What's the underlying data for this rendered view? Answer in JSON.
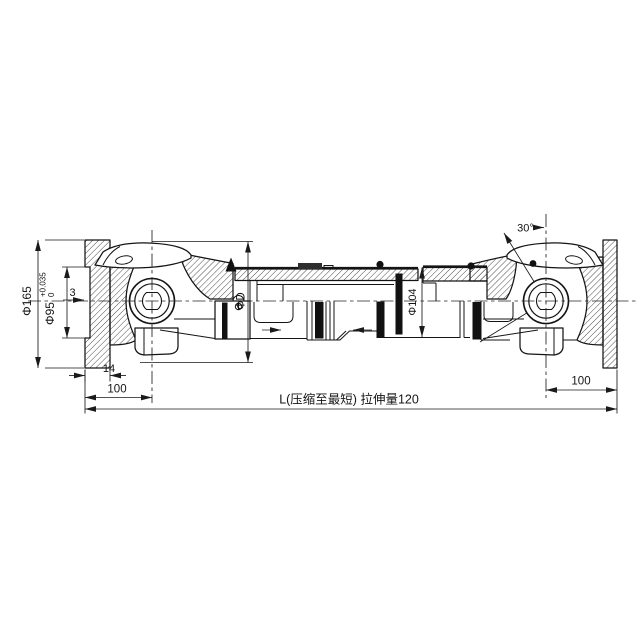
{
  "dimensions": {
    "flange_od": "Φ165",
    "pilot_d": "Φ95",
    "pilot_tol_upper": "+0.035",
    "pilot_tol_lower": "0",
    "pilot_depth": "3",
    "flange_thickness": "14",
    "left_flange_to_joint": "100",
    "right_flange_to_joint": "100",
    "joint_swing_d": "ΦD",
    "tube_od": "Φ104",
    "max_swing_angle": "30°",
    "overall_length": "L(压缩至最短)  拉伸量120"
  },
  "colors": {
    "line": "#141414",
    "seal_black": "#111111",
    "background": "#ffffff"
  }
}
